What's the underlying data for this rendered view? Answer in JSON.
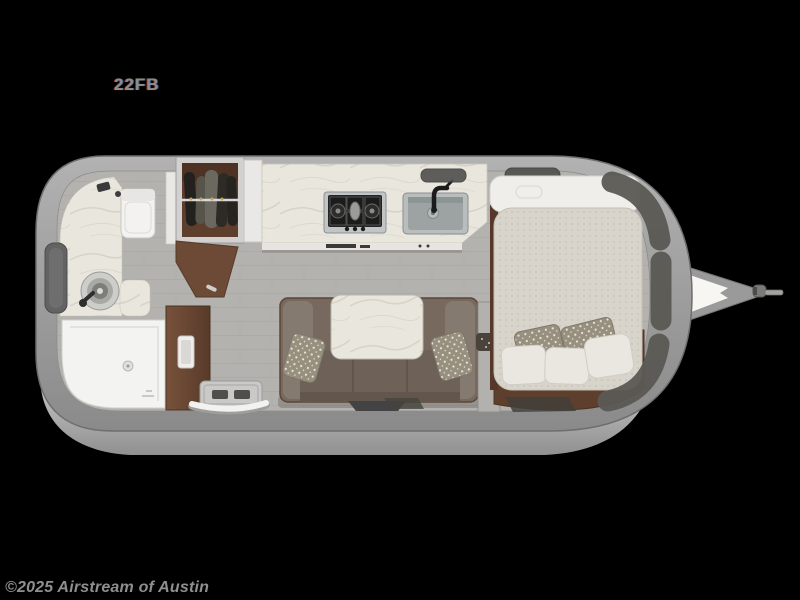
{
  "page": {
    "background_color": "#000000"
  },
  "floorplan": {
    "model_label": "22FB",
    "watermark": "©2025 Airstream of Austin",
    "elements": [
      "shower",
      "toilet",
      "bathroom-vanity-sink",
      "bathroom-mirror",
      "bathroom-door",
      "wardrobe-with-hanging-clothes",
      "wardrobe-open-door",
      "refrigerator-cabinet",
      "kitchen-counter",
      "cooktop",
      "kitchen-sink",
      "roof-vents",
      "dinette-sofa",
      "dinette-table",
      "throw-pillows",
      "bed",
      "bed-headboard-shelf",
      "bed-pillows",
      "front-storage-lockers",
      "entry-step",
      "grab-handle",
      "trailer-shell",
      "hitch-a-frame",
      "hitch-coupler"
    ],
    "colors": {
      "shell-gray": "#9c9c9c",
      "skirt-gray": "#c6c6c6",
      "floor-gray": "#b4b2ae",
      "marble": "#e9e6dd",
      "wood": "#6d4a35",
      "wood-dark": "#5e3e2c",
      "sofa": "#77695e",
      "mattress": "#d8d4cb",
      "pillow-pattern": "#98907f",
      "locker-panel": "#5b5954",
      "label-gray": "#8d8d8d",
      "watermark-gray": "#8f8f8f"
    }
  }
}
